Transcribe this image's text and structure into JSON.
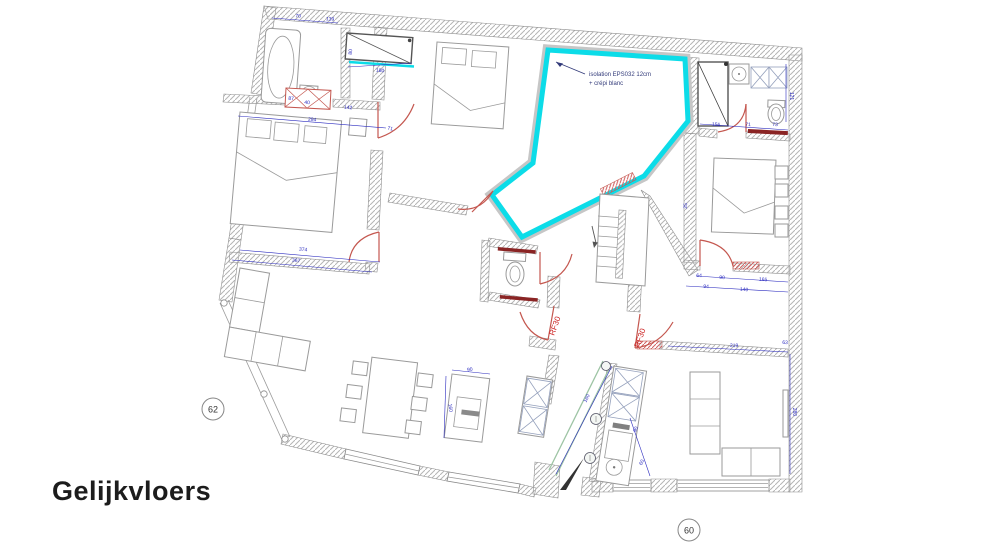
{
  "title": "Gelijkvloers",
  "annotation": {
    "line1": "isolation EPS032 12cm",
    "line2": "+ crépi blanc"
  },
  "markers": {
    "left_circle": "62",
    "bottom_circle": "60"
  },
  "fire_labels": {
    "door1": "RF30",
    "door2": "RF30"
  },
  "dimensions": [
    "70",
    "139",
    "87",
    "40",
    "142",
    "294",
    "71",
    "180",
    "374",
    "367",
    "156",
    "71",
    "73",
    "121",
    "64",
    "90",
    "165",
    "219",
    "63",
    "280",
    "90",
    "160",
    "160",
    "90",
    "60",
    "80",
    "94",
    "140",
    "25"
  ],
  "colors": {
    "highlight_cyan": "#0cdce8",
    "dimension_blue": "#2b2bbf",
    "door_red": "#c4574f",
    "fire_label_red": "#cc2222",
    "sill_darkred": "#8a2424",
    "shaft_green": "#9dc4a4",
    "title_dark": "#1c1c1c"
  }
}
